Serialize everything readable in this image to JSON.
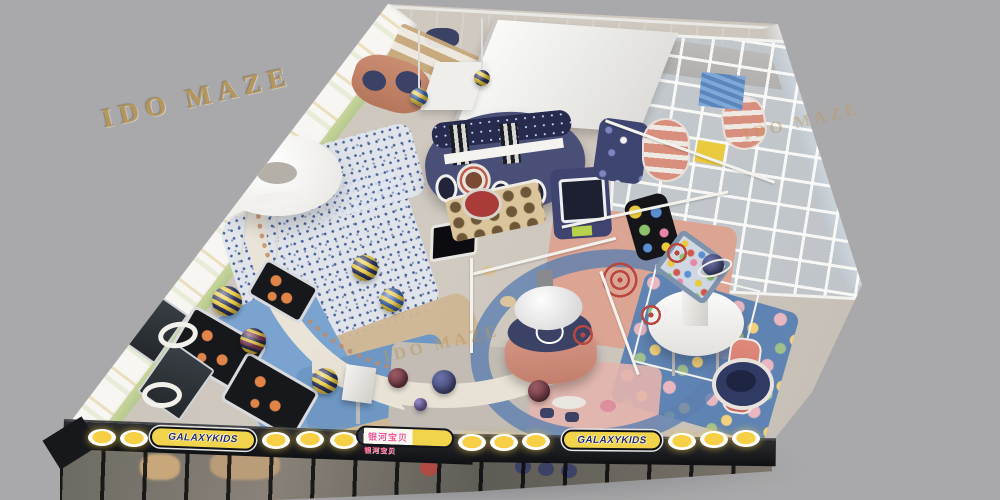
{
  "scene": {
    "description": "Bird's-eye 3D rendering of a Galaxy Kids indoor children's playground (IDO MAZE design render)",
    "background_color": "#a9a9ab"
  },
  "watermarks": {
    "primary": "IDO MAZE",
    "center": "IDO MAZE",
    "right": "IDO MAZE"
  },
  "storefront": {
    "sign_left": "GALAXYKIDS",
    "sign_right": "GALAXYKIDS",
    "sign_center_main": "银河宝贝",
    "sign_center_sub": "银河宝贝",
    "lamp_color": "#f7cf45",
    "fascia_color": "#17181b"
  },
  "palette": {
    "watermark_gold": "#b6965a",
    "navy_structure": "#4a4f78",
    "salmon": "#d89886",
    "pastel_green_wall": "#c8d49b",
    "carpet_blue": "#5f83b2",
    "carpet_salmon": "#dca493",
    "floor_gray": "#cbc4bb",
    "sign_yellow": "#f2d44c"
  }
}
